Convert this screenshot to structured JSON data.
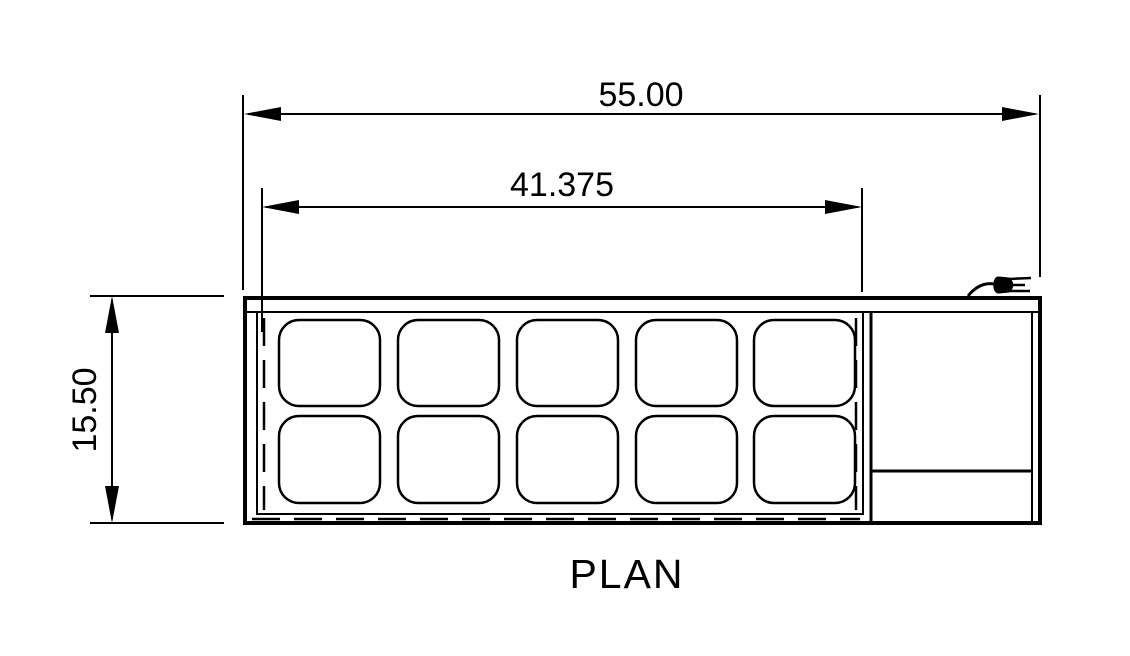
{
  "drawing_title": "PLAN",
  "dimensions": {
    "overall_width": "55.00",
    "interior_width": "41.375",
    "depth": "15.50"
  },
  "plan_view": {
    "pan_rows": 2,
    "pan_columns": 5,
    "pan_count": 10,
    "sections": [
      "pan-well-area",
      "compressor-section"
    ]
  },
  "icons": {
    "power_cord": "power-plug-icon"
  },
  "colors": {
    "line": "#000000",
    "background": "#ffffff"
  }
}
